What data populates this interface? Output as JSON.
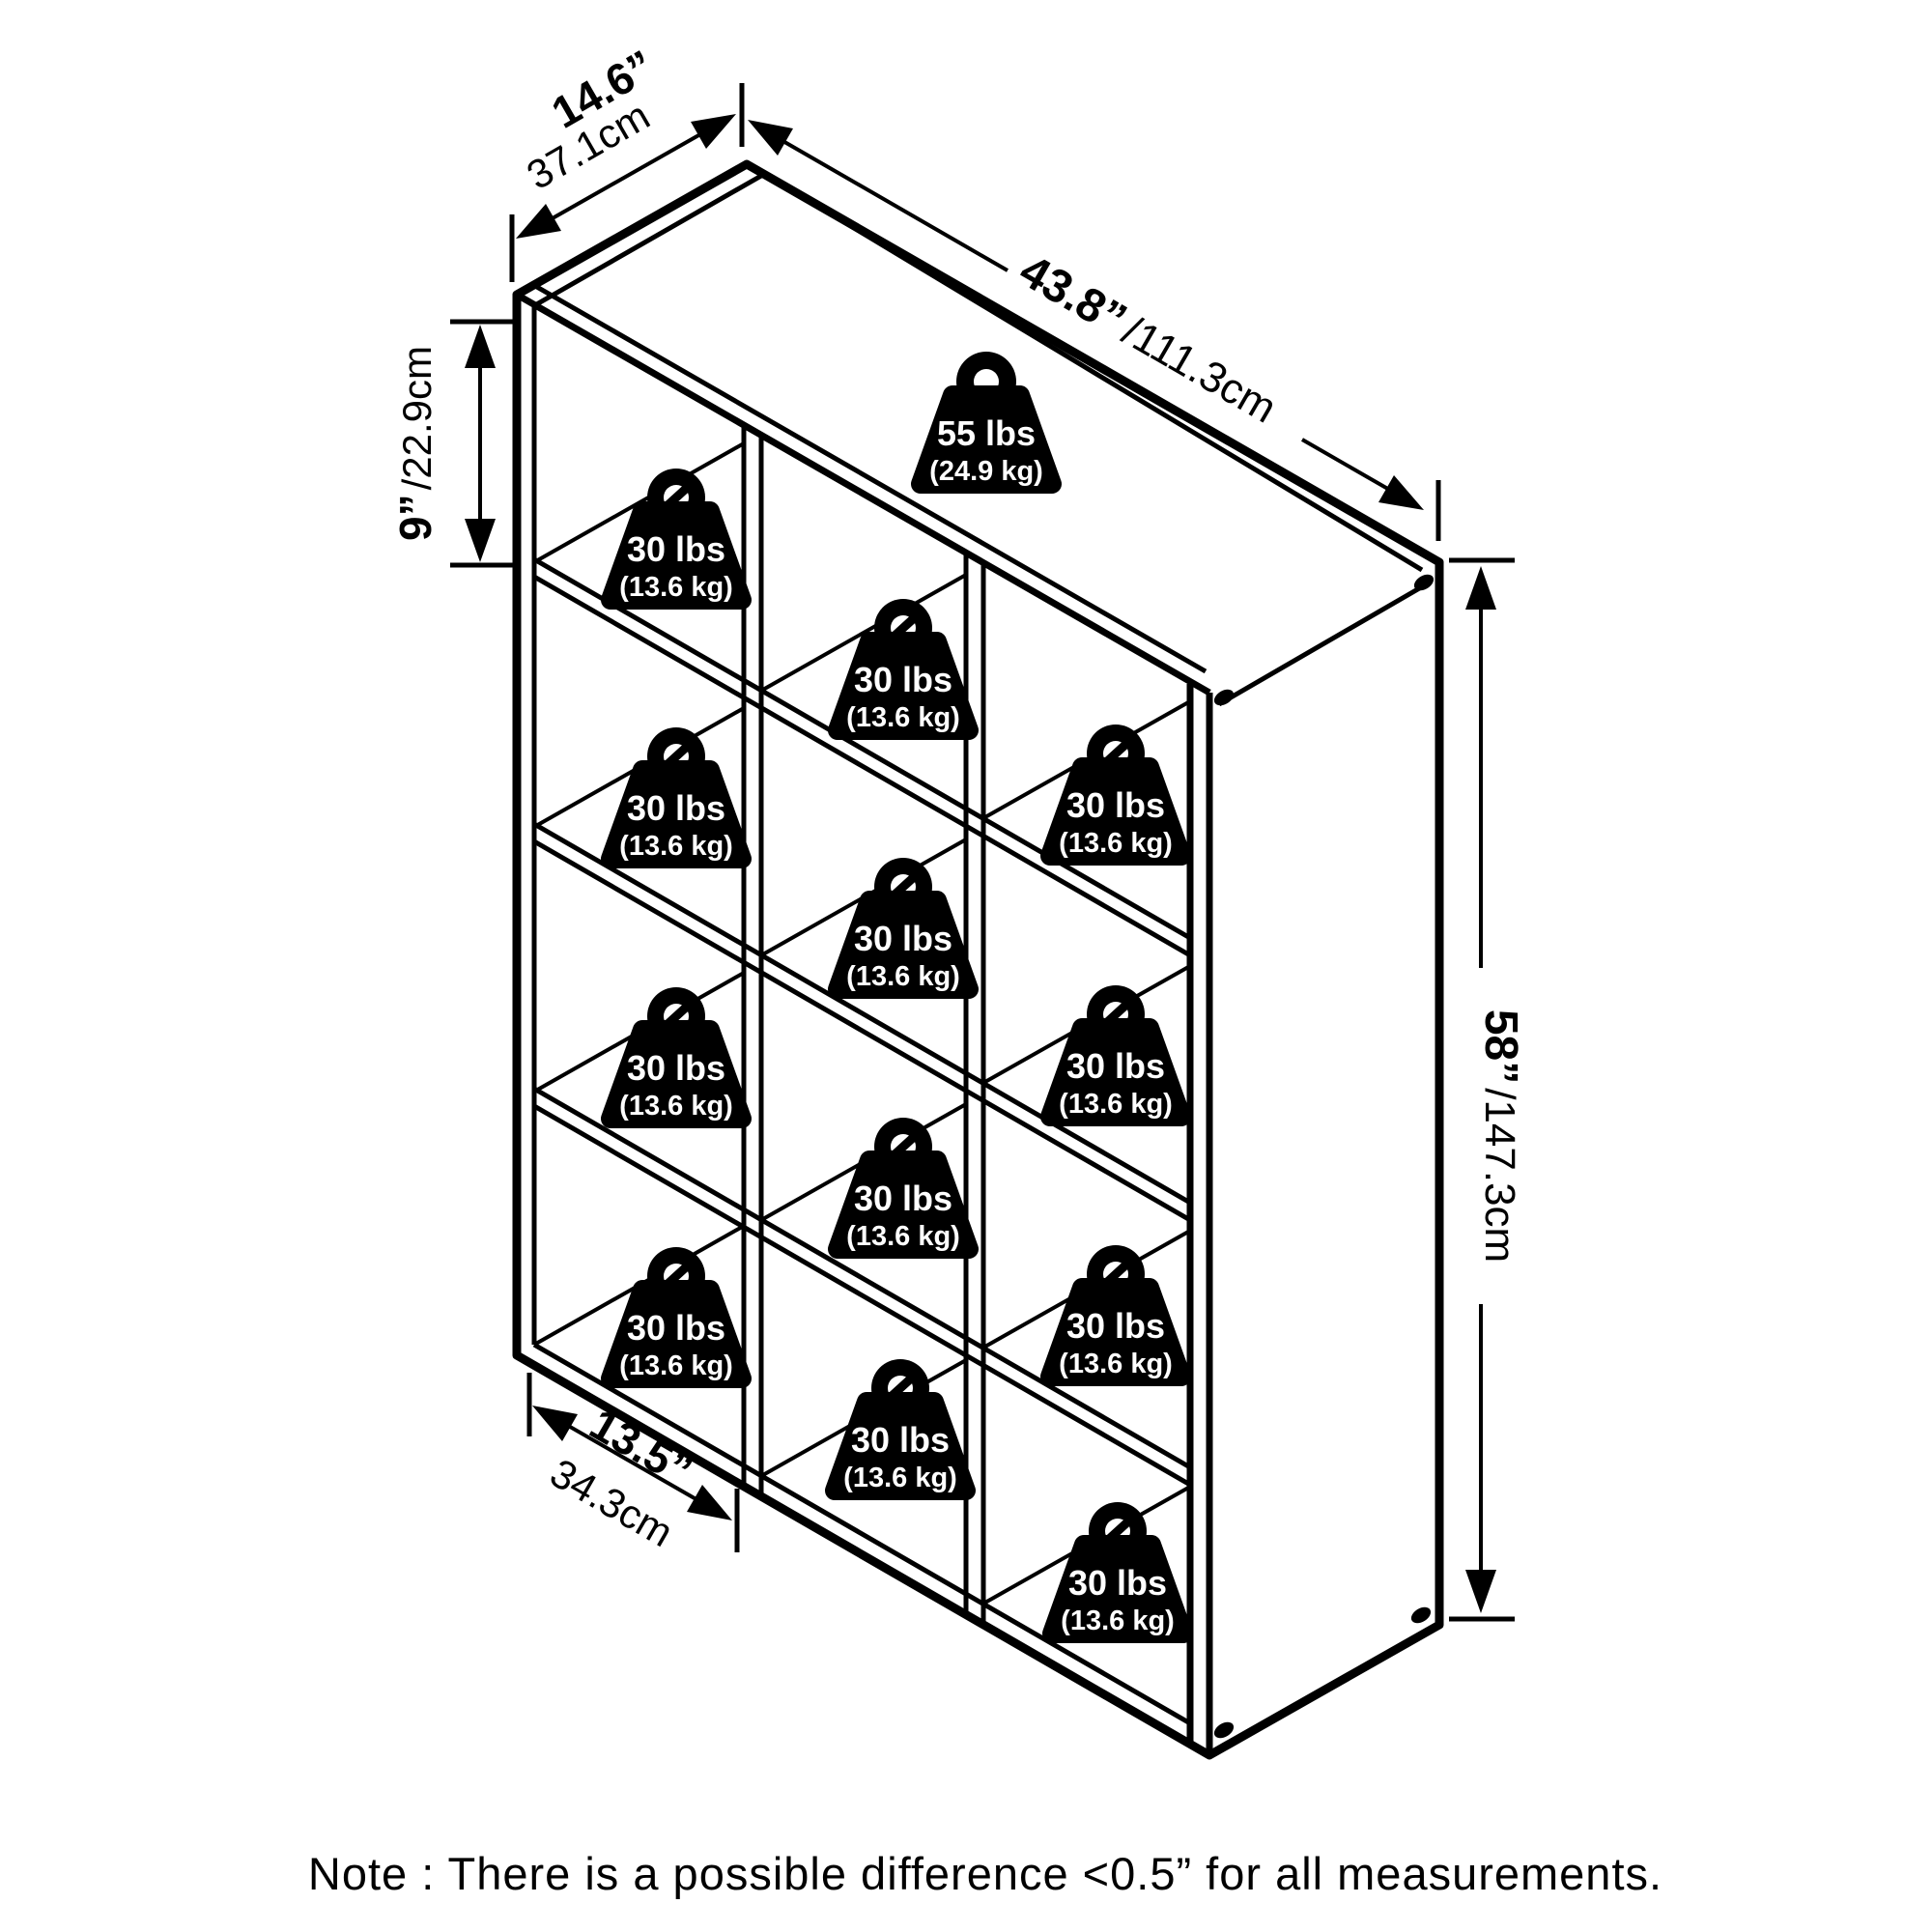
{
  "dimensions": {
    "depth": {
      "inches": "14.6”",
      "cm": "37.1cm"
    },
    "width": {
      "inches": "43.8”",
      "cm": "/111.3cm"
    },
    "cubby_height": {
      "inches": "9”",
      "cm": "/22.9cm"
    },
    "height": {
      "inches": "58”",
      "cm": "/147.3cm"
    },
    "cubby_width": {
      "inches": "13.5”",
      "cm": "34.3cm"
    }
  },
  "weights": {
    "top_shelf": {
      "lbs": "55 lbs",
      "kg": "(24.9 kg)"
    },
    "per_cubby": {
      "lbs": "30 lbs",
      "kg": "(13.6 kg)"
    }
  },
  "note": "Note : There is a possible difference <0.5” for all measurements.",
  "colors": {
    "line": "#000000",
    "background": "#ffffff",
    "badge_fill": "#000000",
    "badge_text": "#ffffff"
  }
}
